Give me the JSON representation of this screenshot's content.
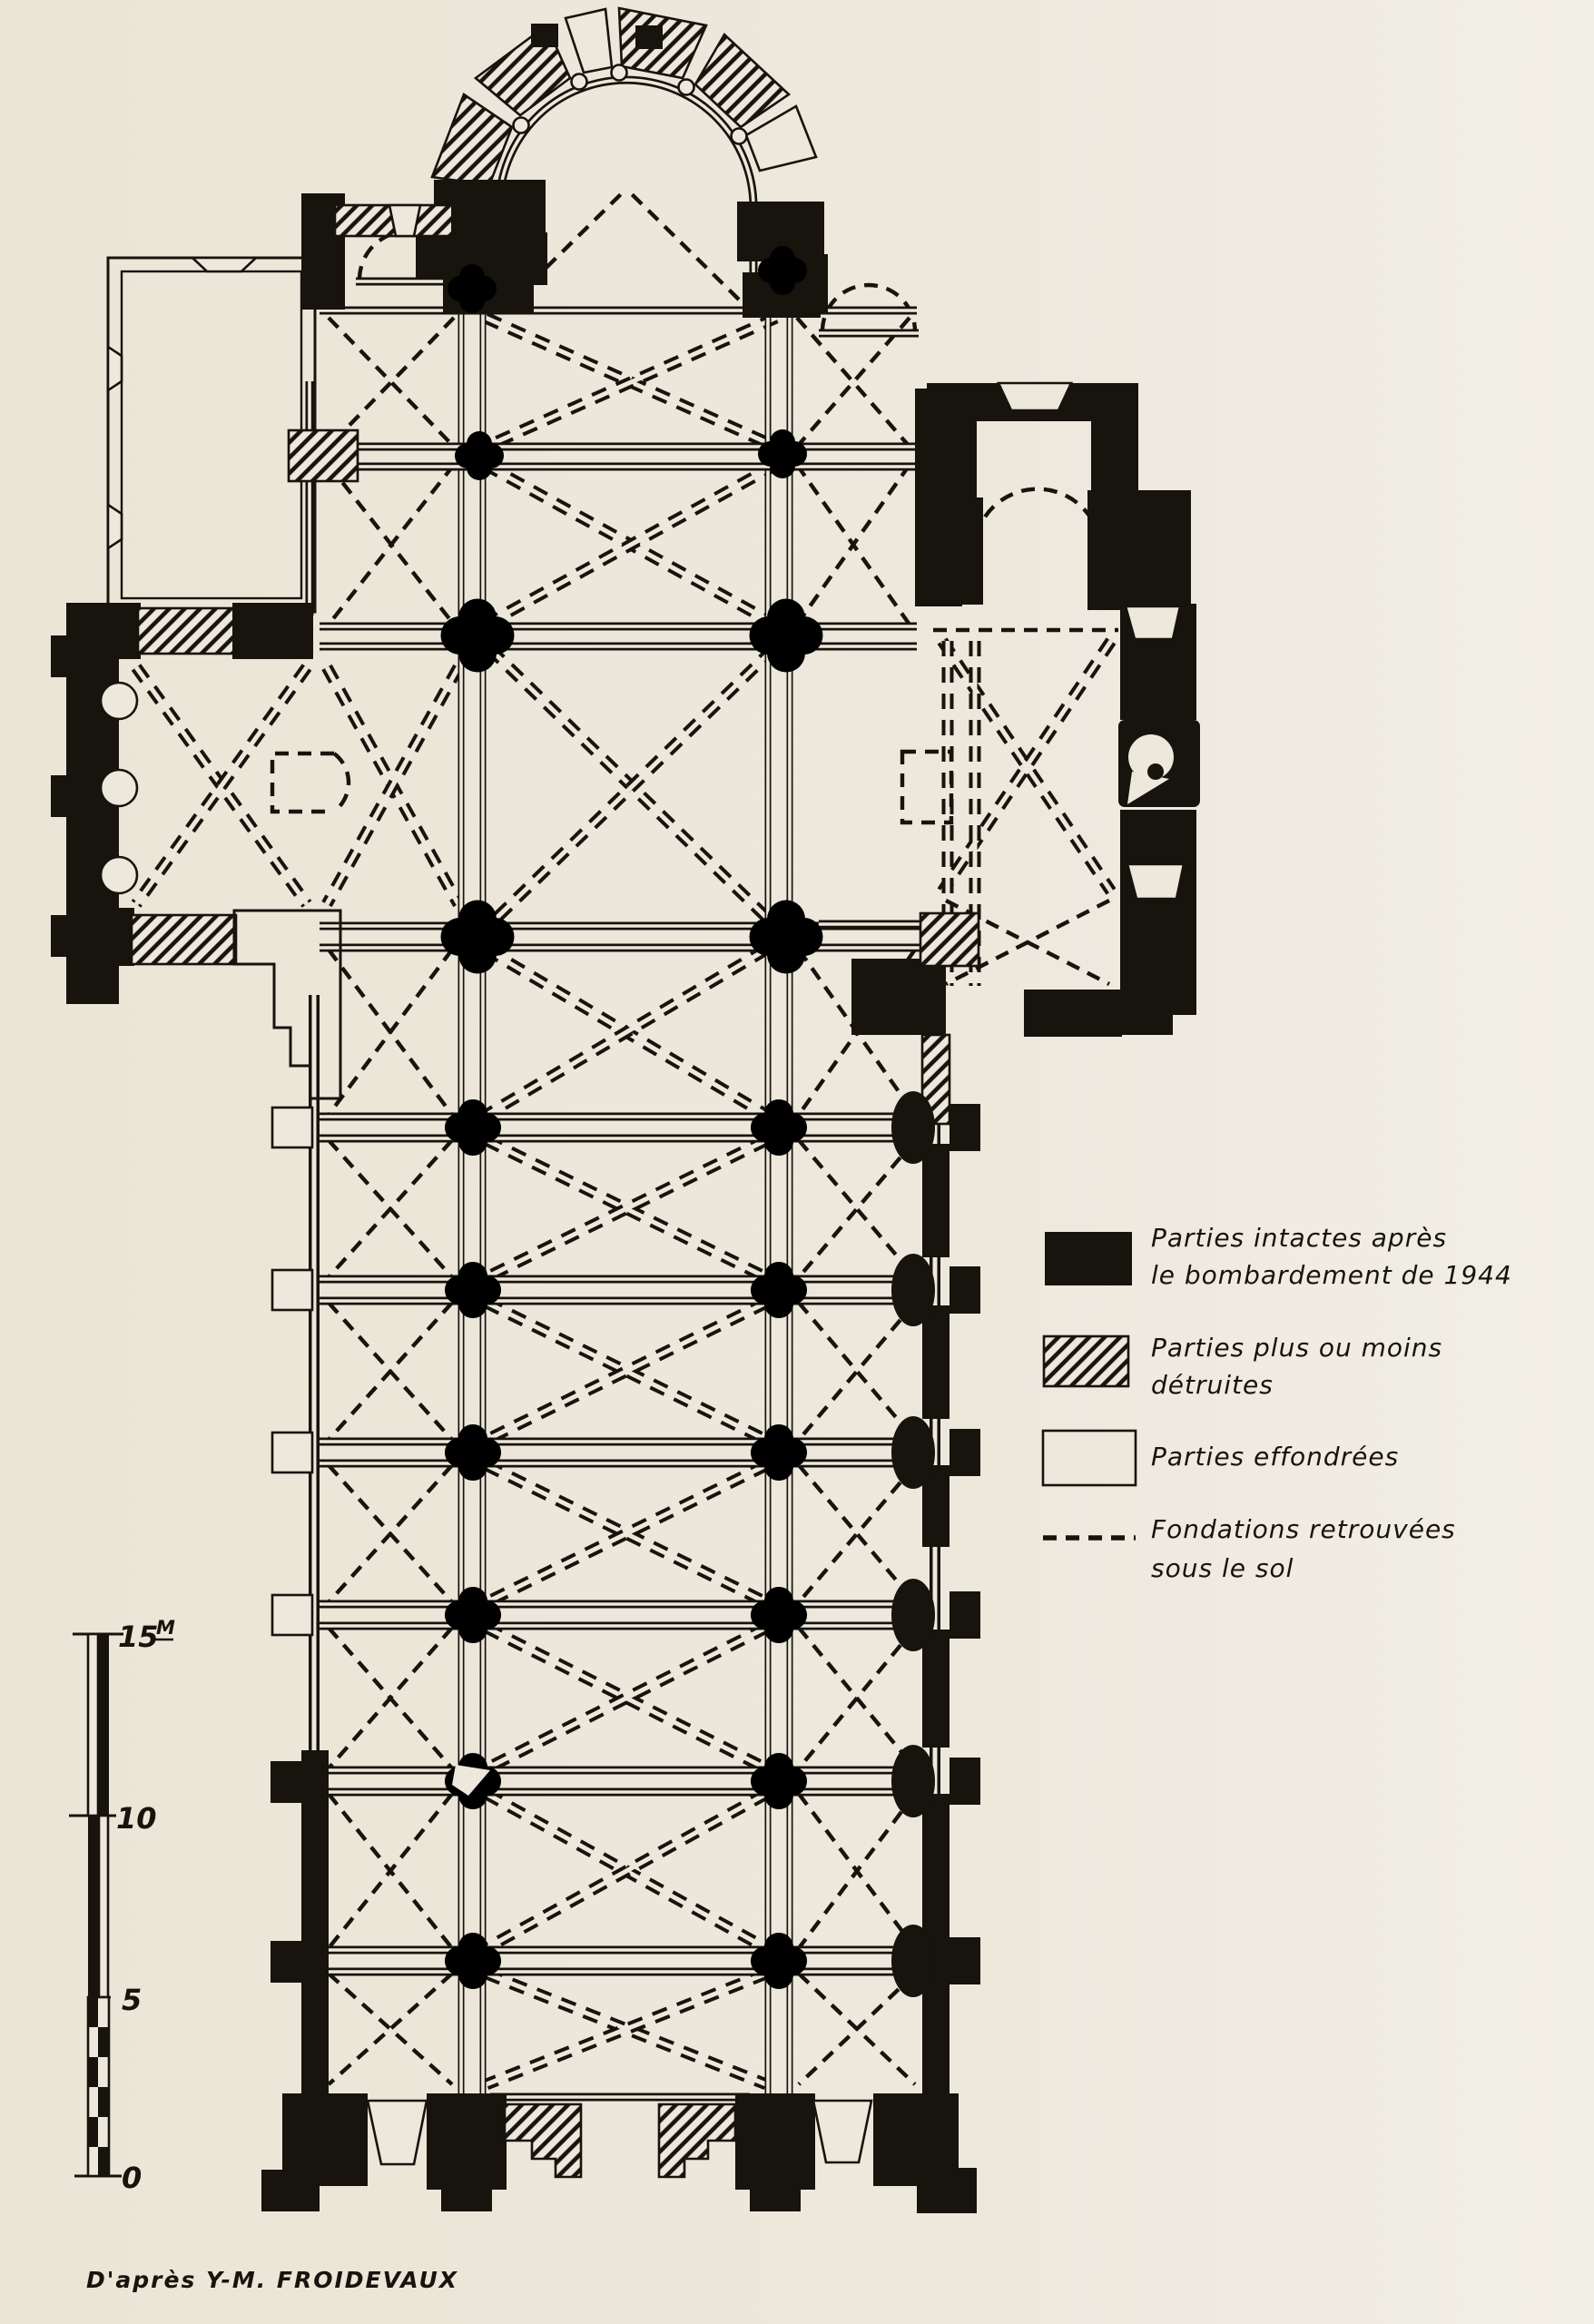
{
  "figure": {
    "kind": "scanned architectural floor plan",
    "subject": "church plan showing condition after the 1944 bombardment"
  },
  "colors": {
    "paper": "#EDE8DC",
    "ink": "#17130D"
  },
  "legend": {
    "items": [
      {
        "swatch": "solid-black",
        "line1": "Parties intactes après",
        "line2": "le bombardement de 1944"
      },
      {
        "swatch": "diagonal-hatch",
        "line1": "Parties plus ou moins",
        "line2": "détruites"
      },
      {
        "swatch": "white-outline",
        "line1": "Parties effondrées",
        "line2": ""
      },
      {
        "swatch": "dashed-line",
        "line1": "Fondations retrouvées",
        "line2": "sous le sol"
      }
    ]
  },
  "scale_bar": {
    "unit_label": "M",
    "tick_labels": [
      "15",
      "10",
      "5",
      "0"
    ]
  },
  "attribution": {
    "text": "D'après Y-M. FROIDEVAUX"
  }
}
